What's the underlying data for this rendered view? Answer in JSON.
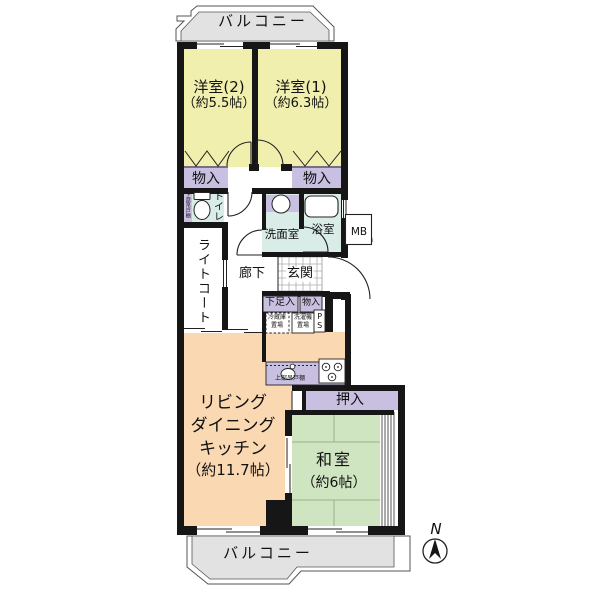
{
  "colors": {
    "wall": "#161616",
    "bedroom": "#f0efae",
    "ldk": "#f9d8b2",
    "tatami": "#cfe5c2",
    "storage": "#c9c0e1",
    "wet": "#d9ece7",
    "balcony": "#e2e2e2"
  },
  "balcony": {
    "top_label": "バルコニー",
    "bottom_label": "バルコニー"
  },
  "rooms": {
    "bedroom2": {
      "name": "洋室(2)",
      "size": "（約5.5帖）"
    },
    "bedroom1": {
      "name": "洋室(1)",
      "size": "（約6.3帖）"
    },
    "storage_left": {
      "label": "物入"
    },
    "storage_right": {
      "label": "物入"
    },
    "toilet": {
      "label": "トイレ",
      "shelf": "上部吊戸棚"
    },
    "light_court": {
      "label": "ライトコート"
    },
    "washroom": {
      "label": "洗面室"
    },
    "bath": {
      "label": "浴室"
    },
    "meter_box": {
      "label": "MB"
    },
    "hallway": {
      "label": "廊下"
    },
    "entrance": {
      "label": "玄関"
    },
    "shoe_storage": {
      "label": "下足入"
    },
    "entrance_storage": {
      "label": "物入"
    },
    "kitchen": {
      "fridge_line1": "冷蔵庫",
      "fridge_line2": "置場",
      "washer_line1": "洗濯機",
      "washer_line2": "置場",
      "pipe_space": "PS",
      "shelf": "上部吊戸棚"
    },
    "ldk": {
      "line1": "リビング",
      "line2": "ダイニング",
      "line3": "キッチン",
      "size": "（約11.7帖）"
    },
    "oshiire": {
      "label": "押入"
    },
    "washitsu": {
      "name": "和室",
      "size": "（約6帖）"
    }
  },
  "compass": {
    "label": "N"
  }
}
